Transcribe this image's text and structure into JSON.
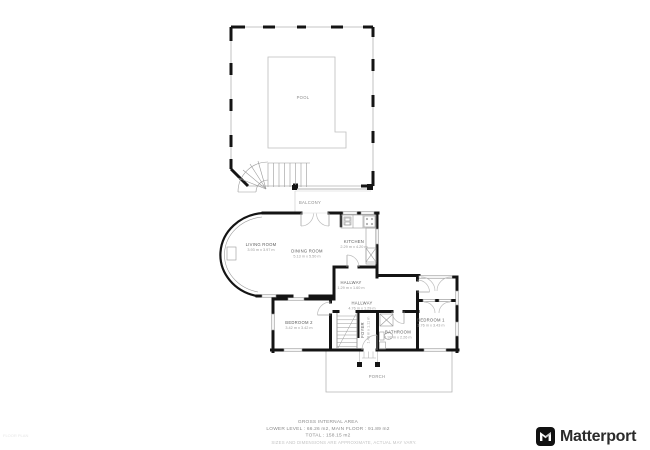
{
  "floorplan": {
    "areas": [
      {
        "name": "POOL"
      },
      {
        "name": "BALCONY"
      },
      {
        "name": "PORCH"
      }
    ],
    "rooms": [
      {
        "name": "LIVING ROOM",
        "dims": "3.93 m x 3.97 m"
      },
      {
        "name": "DINING ROOM",
        "dims": "5.13 m x 5.50 m"
      },
      {
        "name": "KITCHEN",
        "dims": "2.29 m x 4.20 m"
      },
      {
        "name": "HALLWAY",
        "dims": "1.29 m x 1.60 m"
      },
      {
        "name": "HALLWAY",
        "dims": "4.76 m x 1.29 m"
      },
      {
        "name": "FOYER",
        "dims": "1.43 m x 1.11 m"
      },
      {
        "name": "BATHROOM",
        "dims": "1.92 m x 2.26 m"
      },
      {
        "name": "BEDROOM 1",
        "dims": "3.76 m x 3.43 m"
      },
      {
        "name": "BEDROOM 2",
        "dims": "3.42 m x 3.42 m"
      }
    ],
    "footer": {
      "title": "GROSS INTERNAL AREA",
      "levels": "LOWER LEVEL : 66.26 m2, MAIN FLOOR : 91.89 m2",
      "total": "TOTAL : 158.15 m2",
      "disclaimer": "SIZES AND DIMENSIONS ARE APPROXIMATE, ACTUAL MAY VARY."
    },
    "watermark": "FLOOR PLAN"
  },
  "branding": {
    "name": "Matterport"
  },
  "colors": {
    "wall": "#141414",
    "thin_line": "#9a9a9a",
    "door_arc": "#bdbdbd",
    "label": "#5a5a5a",
    "dims": "#9b9b9b",
    "background": "#ffffff",
    "logo_text": "#2b2b2b"
  }
}
